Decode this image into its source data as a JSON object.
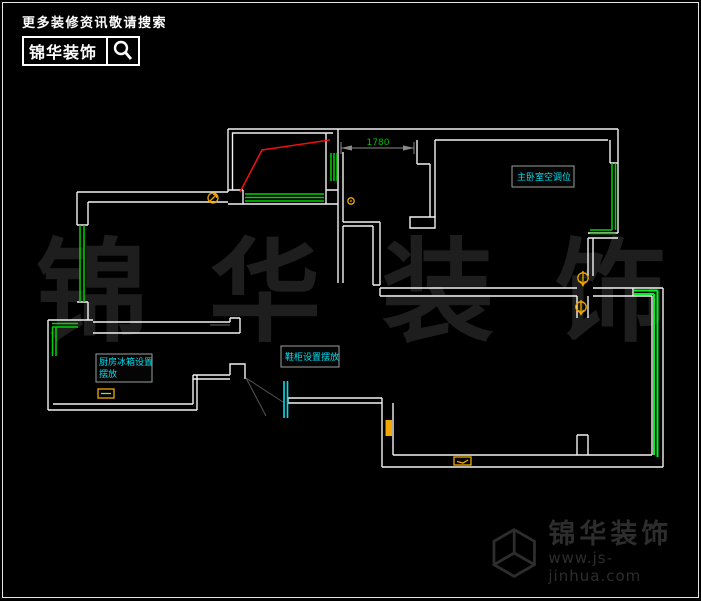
{
  "header": {
    "tagline": "更多装修资讯敬请搜索",
    "brand": "锦华装饰"
  },
  "watermark": "锦 华 装 饰",
  "plan": {
    "dimension_label": "1780",
    "labels": {
      "bedroom_ac": "主卧室空调位",
      "fridge_line1": "厨房冰箱设置",
      "fridge_line2": "摆放",
      "shoe_cabinet": "鞋柜设置摆放"
    }
  },
  "footer": {
    "brand": "锦华装饰",
    "website": "www.js-jinhua.com"
  },
  "colors": {
    "wall": "#f2f2f2",
    "window": "#00d200",
    "window_accent": "#00f020",
    "annotation_red": "#e81010",
    "label_cyan": "#00e0f0",
    "symbol_yellow": "#f0a800",
    "dimension_gray": "#8a8a8a",
    "dimension_text_green": "#00bb00"
  }
}
